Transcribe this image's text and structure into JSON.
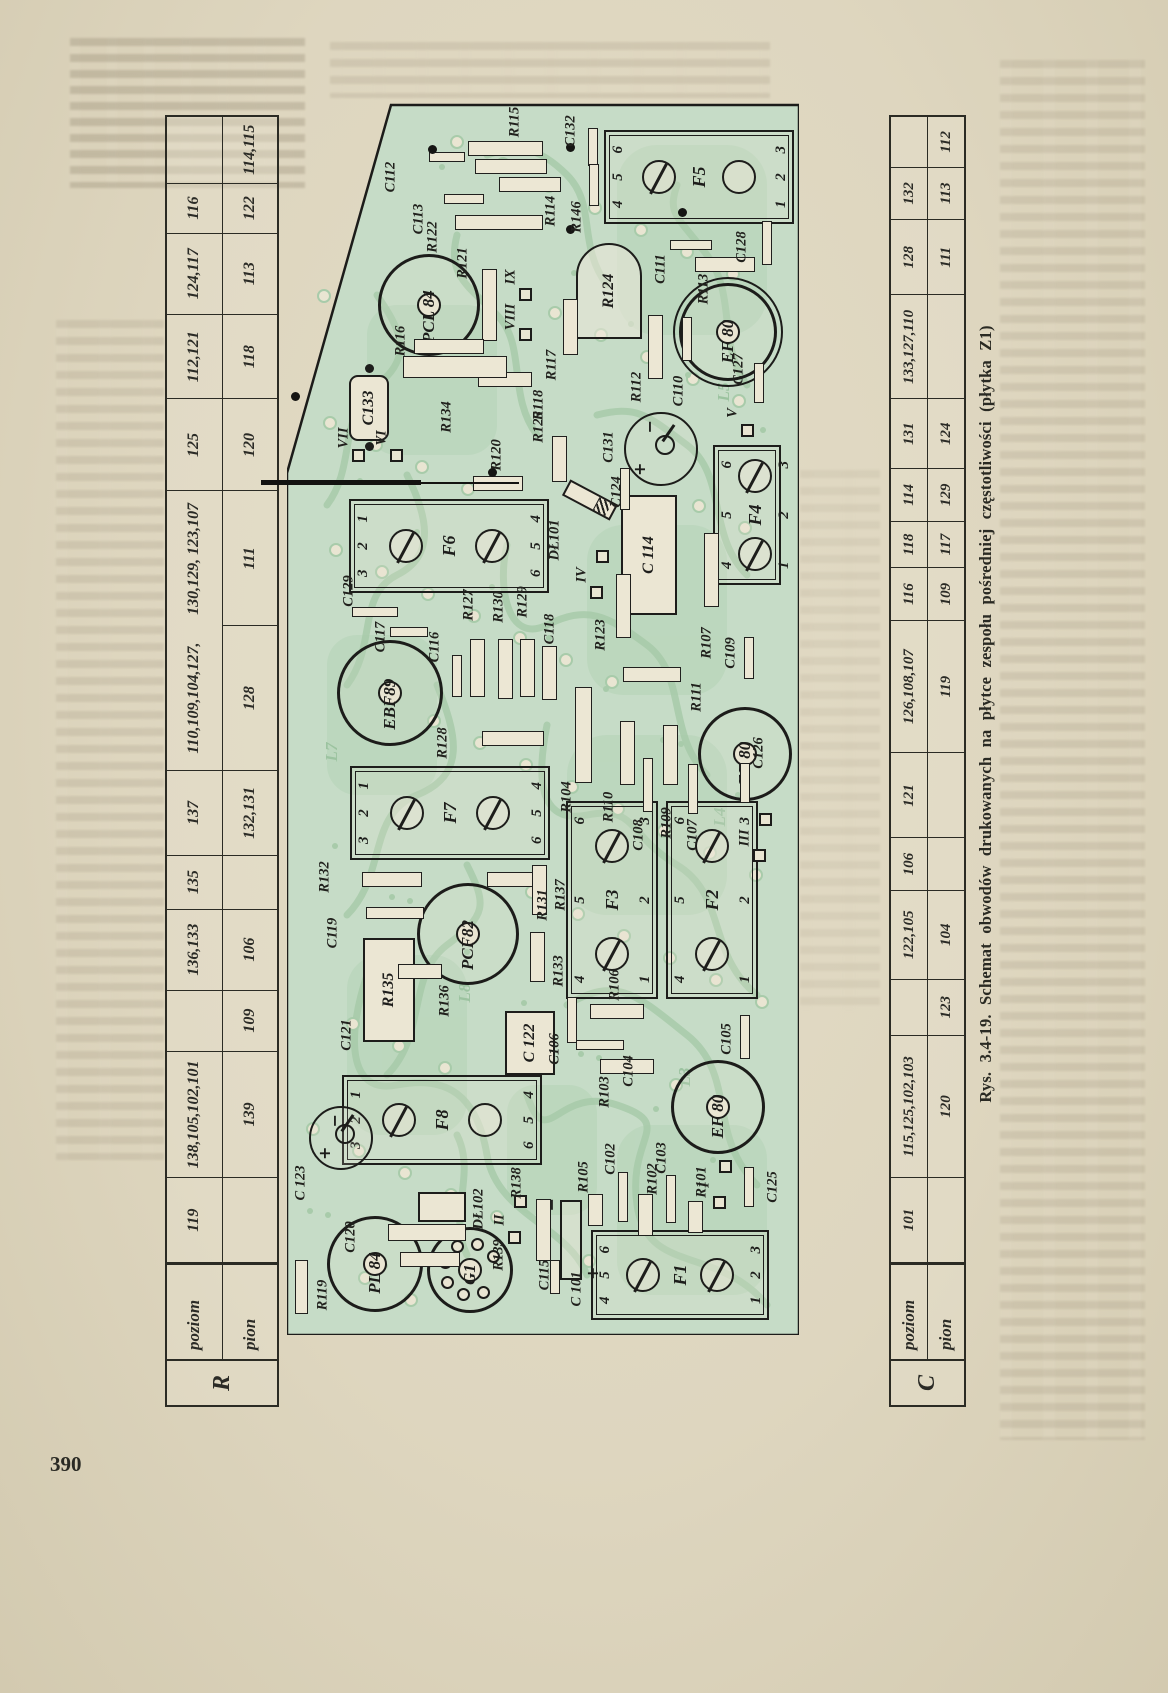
{
  "page": {
    "number": "390"
  },
  "caption": "Rys. 3.4-19. Schemat obwodów drukowanych na płytce zespołu pośredniej częstotliwości (płytka Z1)",
  "tables": {
    "r": {
      "corner": "R",
      "row1": "poziom",
      "row2": "pion",
      "cols": [
        {
          "w": 92,
          "a": "119",
          "b": ""
        },
        {
          "w": 138,
          "a": "138,105,102,101",
          "b": "139"
        },
        {
          "w": 66,
          "a": "",
          "b": "109"
        },
        {
          "w": 88,
          "a": "136,133",
          "b": "106"
        },
        {
          "w": 58,
          "a": "135",
          "b": ""
        },
        {
          "w": 92,
          "a": "137",
          "b": "132,131"
        },
        {
          "w": 158,
          "a": "110,109,104,127,",
          "b": "128"
        },
        {
          "w": 148,
          "a": "130,129, 123,107",
          "b": "111",
          "oa": true
        },
        {
          "w": 100,
          "a": "125",
          "b": "120"
        },
        {
          "w": 92,
          "a": "112,121",
          "b": "118"
        },
        {
          "w": 88,
          "a": "124,117",
          "b": "113"
        },
        {
          "w": 54,
          "a": "116",
          "b": "122"
        },
        {
          "w": 72,
          "a": "",
          "b": "114,115"
        }
      ]
    },
    "c": {
      "corner": "C",
      "row1": "poziom",
      "row2": "pion",
      "cols": [
        {
          "w": 88,
          "a": "101",
          "b": ""
        },
        {
          "w": 148,
          "a": "115,125,102,103",
          "b": "120"
        },
        {
          "w": 58,
          "a": "",
          "b": "123"
        },
        {
          "w": 92,
          "a": "122,105",
          "b": "104"
        },
        {
          "w": 54,
          "a": "106",
          "b": ""
        },
        {
          "w": 88,
          "a": "121",
          "b": ""
        },
        {
          "w": 138,
          "a": "126,108,107",
          "b": "119"
        },
        {
          "w": 54,
          "a": "116",
          "b": "109"
        },
        {
          "w": 48,
          "a": "118",
          "b": "117"
        },
        {
          "w": 54,
          "a": "114",
          "b": "129"
        },
        {
          "w": 72,
          "a": "131",
          "b": "124"
        },
        {
          "w": 108,
          "a": "133,127,110",
          "b": ""
        },
        {
          "w": 78,
          "a": "128",
          "b": "111"
        },
        {
          "w": 54,
          "a": "132",
          "b": "113"
        },
        {
          "w": 52,
          "a": "",
          "b": "112"
        }
      ]
    }
  },
  "pcb": {
    "colors": {
      "board": "#c6dcc7",
      "trace": "#a8cbaa",
      "pad": "#e9e5d2",
      "ink": "#1c1c1a"
    },
    "sockets": [
      {
        "id": "F5",
        "x": 1158,
        "y": 412,
        "w": 94,
        "h": 190,
        "label": "F5",
        "top": "4 5 6",
        "bottom": "1 2 3",
        "screws": [
          "slot",
          "plain"
        ]
      },
      {
        "id": "F6",
        "x": 789,
        "y": 162,
        "w": 94,
        "h": 200,
        "label": "F6",
        "top": "3 2 1",
        "bottom": "6 5 4",
        "screws": [
          "slot",
          "slot"
        ]
      },
      {
        "id": "F7",
        "x": 522,
        "y": 163,
        "w": 94,
        "h": 200,
        "label": "F7",
        "top": "3 2 1",
        "bottom": "6 5 4",
        "screws": [
          "slot",
          "slot"
        ]
      },
      {
        "id": "F8",
        "x": 215,
        "y": 155,
        "w": 90,
        "h": 200,
        "label": "F8",
        "top": "3 2 1",
        "bottom": "6 5 4",
        "screws": [
          "slot",
          "plain"
        ]
      },
      {
        "id": "F1",
        "x": 60,
        "y": 393,
        "w": 90,
        "h": 178,
        "label": "F1",
        "top": "4 5 6",
        "bottom": "1 2 3",
        "screws": [
          "slot",
          "slot"
        ]
      },
      {
        "id": "F2",
        "x": 435,
        "y": 425,
        "w": 198,
        "h": 92,
        "label": "F2",
        "top": "4 5 6",
        "bottom": "1 2 3",
        "screws": [
          "slot",
          "slot"
        ]
      },
      {
        "id": "F3",
        "x": 435,
        "y": 325,
        "w": 198,
        "h": 92,
        "label": "F3",
        "top": "4 5 6",
        "bottom": "1 2 3",
        "screws": [
          "slot",
          "slot"
        ]
      },
      {
        "id": "F4",
        "x": 820,
        "y": 460,
        "w": 140,
        "h": 68,
        "label": "F4",
        "top": "4 5 6",
        "bottom": "1 2 3",
        "screws": [
          "slot",
          "slot"
        ]
      }
    ],
    "tubes": [
      {
        "id": "PCL84",
        "x": 1027,
        "y": 139,
        "r": 48,
        "label": "PCL 84"
      },
      {
        "id": "EF80a",
        "x": 1000,
        "y": 438,
        "r": 46,
        "label": "EF 80",
        "double": true
      },
      {
        "id": "EBF89",
        "x": 639,
        "y": 100,
        "r": 50,
        "label": "EBF89"
      },
      {
        "id": "EF80b",
        "x": 578,
        "y": 455,
        "r": 44,
        "label": "EF 80"
      },
      {
        "id": "PCF82",
        "x": 398,
        "y": 178,
        "r": 48,
        "label": "PCF82"
      },
      {
        "id": "EF80c",
        "x": 225,
        "y": 428,
        "r": 44,
        "label": "EF 80"
      },
      {
        "id": "PL84",
        "x": 68,
        "y": 85,
        "r": 45,
        "label": "PL 84"
      },
      {
        "id": "G1",
        "x": 62,
        "y": 180,
        "r": 40,
        "label": "G1",
        "pins": true
      }
    ],
    "ecaps": [
      {
        "id": "C124",
        "x": 884,
        "y": 372,
        "r": 35,
        "label": "C124",
        "lx": 843,
        "ly": 330
      },
      {
        "id": "C123",
        "x": 195,
        "y": 52,
        "r": 30,
        "label": "C 123",
        "lx": 152,
        "ly": 14
      }
    ],
    "boxes": [
      {
        "id": "C114",
        "x": 780,
        "y": 362,
        "w": 120,
        "h": 56,
        "label": "C 114"
      },
      {
        "id": "C122",
        "x": 292,
        "y": 243,
        "w": 64,
        "h": 50,
        "label": "C 122"
      },
      {
        "id": "C121",
        "x": 345,
        "y": 102,
        "w": 104,
        "h": 52,
        "label": "R135",
        "outer": "C121",
        "ox": 300,
        "oy": 60
      },
      {
        "id": "C133",
        "x": 927,
        "y": 82,
        "w": 66,
        "h": 40,
        "label": "C133",
        "round": true,
        "dots": true
      },
      {
        "id": "R124",
        "x": 1044,
        "y": 322,
        "w": 96,
        "h": 66,
        "label": "R124",
        "canr": true
      },
      {
        "id": "DL102",
        "x": 128,
        "y": 155,
        "w": 30,
        "h": 48,
        "label": "",
        "outer": "DŁ102",
        "ox": 126,
        "oy": 192
      }
    ],
    "diode": {
      "x": 835,
      "y": 303,
      "w": 54,
      "h": 18,
      "rot": -62,
      "label": "DŁ101",
      "lx": 795,
      "ly": 268
    },
    "rcap": {
      "x": 95,
      "y": 284,
      "w": 80,
      "h": 22,
      "label": "C115",
      "lx": 60,
      "ly": 258
    },
    "bars": [
      {
        "o": "v",
        "x": 1186,
        "y": 218,
        "len": 75,
        "label": "R115",
        "lx": 1213,
        "ly": 228
      },
      {
        "o": "v",
        "x": 1168,
        "y": 224,
        "len": 72
      },
      {
        "o": "v",
        "x": 1150,
        "y": 243,
        "len": 62,
        "label": "R114",
        "lx": 1124,
        "ly": 264
      },
      {
        "o": "v",
        "x": 1178,
        "y": 160,
        "len": 36,
        "t": 10,
        "label": "C112",
        "lx": 1158,
        "ly": 104
      },
      {
        "o": "v",
        "x": 1136,
        "y": 177,
        "len": 40,
        "t": 10,
        "label": "C113",
        "lx": 1116,
        "ly": 132
      },
      {
        "o": "v",
        "x": 1112,
        "y": 212,
        "len": 88,
        "label": "R122",
        "lx": 1098,
        "ly": 146
      },
      {
        "o": "h",
        "x": 1030,
        "y": 202,
        "len": 72,
        "label": "R121",
        "lx": 1072,
        "ly": 176
      },
      {
        "o": "h",
        "x": 1188,
        "y": 306,
        "len": 38,
        "t": 10,
        "label": "C132",
        "lx": 1204,
        "ly": 284
      },
      {
        "o": "h",
        "x": 1150,
        "y": 307,
        "len": 42,
        "t": 10,
        "label": "R146",
        "lx": 1118,
        "ly": 290
      },
      {
        "o": "h",
        "x": 1008,
        "y": 283,
        "len": 56,
        "label": "R117",
        "lx": 970,
        "ly": 265
      },
      {
        "o": "v",
        "x": 988,
        "y": 162,
        "len": 70,
        "label": "R116",
        "lx": 994,
        "ly": 114
      },
      {
        "o": "v",
        "x": 955,
        "y": 218,
        "len": 54,
        "label": "R118",
        "lx": 930,
        "ly": 252
      },
      {
        "o": "v",
        "x": 968,
        "y": 168,
        "len": 104,
        "t": 22,
        "label": "R134",
        "lx": 918,
        "ly": 160
      },
      {
        "o": "h",
        "x": 988,
        "y": 368,
        "len": 64,
        "label": "R112",
        "lx": 948,
        "ly": 350
      },
      {
        "o": "h",
        "x": 996,
        "y": 400,
        "len": 44,
        "t": 10,
        "label": "C110",
        "lx": 944,
        "ly": 392
      },
      {
        "o": "v",
        "x": 1090,
        "y": 404,
        "len": 42,
        "t": 10,
        "label": "C111",
        "lx": 1066,
        "ly": 374
      },
      {
        "o": "v",
        "x": 1070,
        "y": 438,
        "len": 60,
        "label": "R113",
        "lx": 1046,
        "ly": 417
      },
      {
        "o": "h",
        "x": 1092,
        "y": 480,
        "len": 44,
        "t": 10,
        "label": "C128",
        "lx": 1088,
        "ly": 455
      },
      {
        "o": "h",
        "x": 876,
        "y": 272,
        "len": 46,
        "label": "R125",
        "lx": 908,
        "ly": 252
      },
      {
        "o": "v",
        "x": 851,
        "y": 211,
        "len": 50,
        "label": "R120",
        "lx": 880,
        "ly": 210
      },
      {
        "o": "h",
        "x": 846,
        "y": 338,
        "len": 42,
        "t": 10,
        "label": "C131",
        "lx": 888,
        "ly": 322
      },
      {
        "o": "h",
        "x": 729,
        "y": 336,
        "len": 64,
        "label": "R123",
        "lx": 700,
        "ly": 314
      },
      {
        "o": "h",
        "x": 765,
        "y": 424,
        "len": 74,
        "label": "R107",
        "lx": 692,
        "ly": 420
      },
      {
        "o": "v",
        "x": 596,
        "y": 226,
        "len": 62,
        "label": "R128",
        "lx": 592,
        "ly": 156
      },
      {
        "o": "v",
        "x": 723,
        "y": 88,
        "len": 46,
        "t": 10,
        "label": "C129",
        "lx": 744,
        "ly": 62
      },
      {
        "o": "v",
        "x": 703,
        "y": 122,
        "len": 38,
        "t": 10,
        "label": "C117",
        "lx": 698,
        "ly": 94
      },
      {
        "o": "h",
        "x": 659,
        "y": 170,
        "len": 42,
        "t": 10,
        "label": "C116",
        "lx": 688,
        "ly": 148
      },
      {
        "o": "h",
        "x": 667,
        "y": 190,
        "len": 58,
        "label": "R127",
        "lx": 730,
        "ly": 182
      },
      {
        "o": "h",
        "x": 666,
        "y": 218,
        "len": 60,
        "label": "R130",
        "lx": 728,
        "ly": 212
      },
      {
        "o": "h",
        "x": 667,
        "y": 240,
        "len": 58,
        "label": "R129",
        "lx": 733,
        "ly": 236
      },
      {
        "o": "h",
        "x": 662,
        "y": 262,
        "len": 54,
        "label": "C118",
        "lx": 706,
        "ly": 263
      },
      {
        "o": "h",
        "x": 600,
        "y": 296,
        "len": 96,
        "t": 17,
        "label": "R104",
        "lx": 538,
        "ly": 280
      },
      {
        "o": "h",
        "x": 582,
        "y": 340,
        "len": 64,
        "label": "R110",
        "lx": 528,
        "ly": 322
      },
      {
        "o": "h",
        "x": 550,
        "y": 361,
        "len": 54,
        "t": 10,
        "label": "C108",
        "lx": 500,
        "ly": 352
      },
      {
        "o": "h",
        "x": 580,
        "y": 383,
        "len": 60,
        "label": "R109",
        "lx": 512,
        "ly": 380
      },
      {
        "o": "h",
        "x": 546,
        "y": 406,
        "len": 50,
        "t": 10,
        "label": "C107",
        "lx": 500,
        "ly": 406
      },
      {
        "o": "v",
        "x": 660,
        "y": 365,
        "len": 58,
        "label": "R111",
        "lx": 638,
        "ly": 410
      },
      {
        "o": "h",
        "x": 677,
        "y": 462,
        "len": 42,
        "t": 10,
        "label": "C109",
        "lx": 682,
        "ly": 444
      },
      {
        "o": "h",
        "x": 552,
        "y": 458,
        "len": 40,
        "t": 10,
        "label": "C126",
        "lx": 582,
        "ly": 472
      },
      {
        "o": "v",
        "x": 455,
        "y": 105,
        "len": 60,
        "label": "R132",
        "lx": 458,
        "ly": 38
      },
      {
        "o": "v",
        "x": 422,
        "y": 108,
        "len": 58,
        "t": 12,
        "label": "C119",
        "lx": 402,
        "ly": 46
      },
      {
        "o": "v",
        "x": 455,
        "y": 228,
        "len": 56,
        "label": "R131",
        "lx": 430,
        "ly": 256
      },
      {
        "o": "h",
        "x": 445,
        "y": 252,
        "len": 50,
        "label": "R137",
        "lx": 440,
        "ly": 274
      },
      {
        "o": "h",
        "x": 378,
        "y": 250,
        "len": 50,
        "label": "R133",
        "lx": 364,
        "ly": 272
      },
      {
        "o": "v",
        "x": 363,
        "y": 133,
        "len": 44,
        "label": "R136",
        "lx": 334,
        "ly": 158
      },
      {
        "o": "h",
        "x": 315,
        "y": 285,
        "len": 46,
        "t": 10,
        "label": "C106",
        "lx": 286,
        "ly": 268
      },
      {
        "o": "v",
        "x": 323,
        "y": 330,
        "len": 54,
        "label": "R106",
        "lx": 350,
        "ly": 328
      },
      {
        "o": "v",
        "x": 290,
        "y": 313,
        "len": 48,
        "t": 10,
        "label": "C104",
        "lx": 264,
        "ly": 342
      },
      {
        "o": "h",
        "x": 298,
        "y": 458,
        "len": 44,
        "t": 10,
        "label": "C105",
        "lx": 296,
        "ly": 440
      },
      {
        "o": "v",
        "x": 268,
        "y": 340,
        "len": 54,
        "label": "R103",
        "lx": 243,
        "ly": 318
      },
      {
        "o": "v",
        "x": 102,
        "y": 140,
        "len": 78,
        "t": 17,
        "label": "C120",
        "lx": 98,
        "ly": 64
      },
      {
        "o": "v",
        "x": 75,
        "y": 143,
        "len": 60,
        "label": "R139",
        "lx": 80,
        "ly": 212
      },
      {
        "o": "h",
        "x": 105,
        "y": 256,
        "len": 62,
        "label": "R138",
        "lx": 152,
        "ly": 230
      },
      {
        "o": "h",
        "x": 125,
        "y": 308,
        "len": 32,
        "label": "R105",
        "lx": 158,
        "ly": 297
      },
      {
        "o": "h",
        "x": 138,
        "y": 336,
        "len": 50,
        "t": 10,
        "label": "C102",
        "lx": 176,
        "ly": 324
      },
      {
        "o": "h",
        "x": 120,
        "y": 358,
        "len": 42,
        "label": "R102",
        "lx": 156,
        "ly": 366
      },
      {
        "o": "h",
        "x": 136,
        "y": 384,
        "len": 48,
        "t": 10,
        "label": "C103",
        "lx": 177,
        "ly": 375
      },
      {
        "o": "h",
        "x": 118,
        "y": 408,
        "len": 32,
        "label": "R101",
        "lx": 153,
        "ly": 415
      },
      {
        "o": "h",
        "x": 58,
        "y": 268,
        "len": 34,
        "t": 10,
        "label": "C 101",
        "lx": 46,
        "ly": 290
      },
      {
        "o": "h",
        "x": 48,
        "y": 14,
        "len": 54,
        "t": 13,
        "label": "R119",
        "lx": 40,
        "ly": 36
      },
      {
        "o": "h",
        "x": 148,
        "y": 462,
        "len": 40,
        "t": 10,
        "label": "C125",
        "lx": 148,
        "ly": 486
      },
      {
        "o": "h",
        "x": 952,
        "y": 472,
        "len": 40,
        "t": 10,
        "label": "C127",
        "lx": 966,
        "ly": 452
      }
    ],
    "romans": [
      {
        "n": "IX",
        "x": 1058,
        "y": 224,
        "sq": 1
      },
      {
        "n": "VIII",
        "x": 1018,
        "y": 224,
        "sq": 1
      },
      {
        "n": "VII",
        "x": 897,
        "y": 57,
        "sq": 1
      },
      {
        "n": "VI",
        "x": 897,
        "y": 95,
        "sq": 1
      },
      {
        "n": "V",
        "x": 922,
        "y": 446,
        "sq": 1
      },
      {
        "n": "IV",
        "x": 760,
        "y": 295,
        "sq": 2
      },
      {
        "n": "III",
        "x": 497,
        "y": 458,
        "sq": 2
      },
      {
        "n": "II",
        "x": 115,
        "y": 213,
        "sq": 2
      },
      {
        "n": "I",
        "x": 150,
        "y": 418,
        "sq": 2
      }
    ],
    "ghosts": [
      {
        "n": "L7",
        "x": 583,
        "y": 45
      },
      {
        "n": "L8",
        "x": 342,
        "y": 178
      },
      {
        "n": "L5",
        "x": 943,
        "y": 437
      },
      {
        "n": "L4",
        "x": 518,
        "y": 433
      },
      {
        "n": "L3",
        "x": 258,
        "y": 398
      }
    ],
    "dots": [
      [
        1185,
        145
      ],
      [
        1187,
        283
      ],
      [
        1105,
        283
      ],
      [
        1122,
        395
      ],
      [
        938,
        8
      ],
      [
        862,
        205
      ]
    ]
  }
}
